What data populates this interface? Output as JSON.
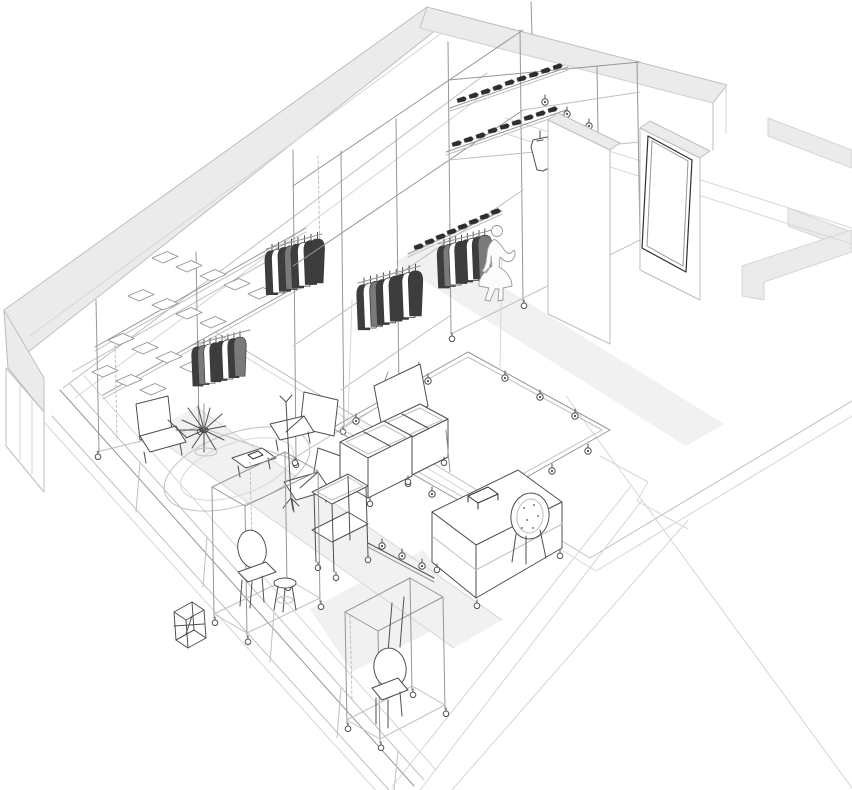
{
  "meta": {
    "title": "Axonometric cutaway line drawing of a retail clothing store interior",
    "description": "Technical wireframe perspective of a shop fit-out: modular scaffold display racks on casters with hanging garments, shoe shelves, tile display table, ceiling lighting rig with spotlights, lounge seating on a round rug, bin carts, cash desk with rattan chair, and a customer silhouette inside a cut-open building shell.",
    "canvas_width": 852,
    "canvas_height": 790
  },
  "palette": {
    "background": "#ffffff",
    "line_faint": "#d6d6d6",
    "line_light": "#bfbfbf",
    "line_mid": "#969696",
    "line_dark": "#4f4f4f",
    "line_black": "#2e2e2e",
    "slab_fill": "#ebebeb",
    "slab_soft": "#f1f1f1",
    "garment_dark": "#3d3d3d",
    "garment_mid": "#7a7a7a",
    "shoe_fill": "#2e2e2e",
    "silhouette_fill": "#fcfcfc"
  },
  "scene": {
    "building_elements": [
      "perimeter wall with thick grey top band",
      "left corner wall",
      "storefront glazing with mullions",
      "interior partition slabs",
      "leaning mirror panel",
      "floor plan outline extending bottom right"
    ],
    "fixtures": [
      "scaffold display cage",
      "tile display table",
      "shoe shelves",
      "garment rails with hanging clothes",
      "ceiling lighting rig with spotlights",
      "hanging artwork panel",
      "lounge seating area with round rug and spider lamp",
      "magazine table",
      "coat stand",
      "open bin carts",
      "two-tier bin trolley",
      "floor spotlight track",
      "cash desk with rattan chair",
      "rolling rack with chair and stool",
      "rolling rack with suspended chair",
      "small cube stool",
      "customer silhouette"
    ],
    "counts": {
      "display_tiles": 18,
      "garment_clusters": 4,
      "garments_total": 33,
      "shoe_rows": 3,
      "shoes_total": 26,
      "rig_spotlights": 12,
      "track_spotlights": 3,
      "ceiling_spots": 3,
      "lounge_chairs": 3,
      "bin_carts": 3,
      "rolling_racks": 2,
      "stools": 2,
      "people": 1
    }
  }
}
